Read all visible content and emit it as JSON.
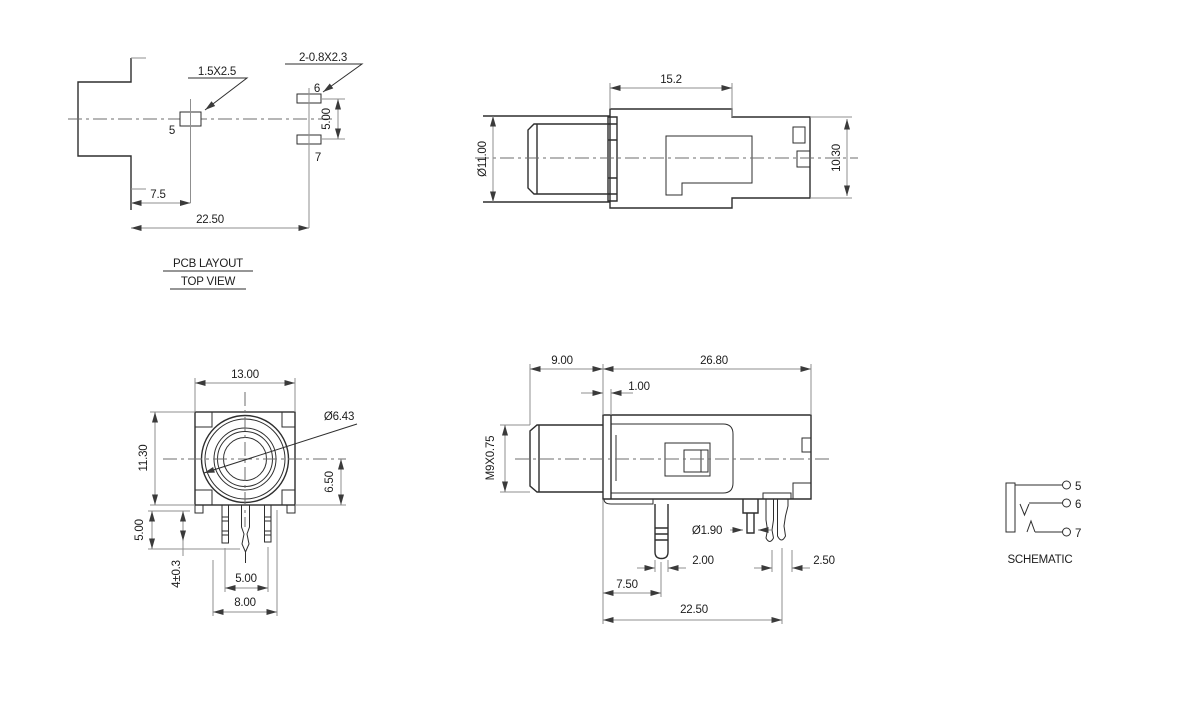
{
  "drawing": {
    "background": "#ffffff",
    "outline_color": "#2e2e2e",
    "dimension_color": "#8f8f8f",
    "text_color": "#1d1d1d"
  },
  "pcb_layout": {
    "title": "PCB LAYOUT",
    "subtitle": "TOP VIEW",
    "pad5_callout": "1.5X2.5",
    "pads67_callout": "2-0.8X2.3",
    "pin5": "5",
    "pin6": "6",
    "pin7": "7",
    "dim_pad_spacing": "5.00",
    "dim_pad5_offset": "7.5",
    "dim_pads67_offset": "22.50"
  },
  "side_view": {
    "dim_body_length": "15.2",
    "dim_barrel_diameter": "Ø11.00",
    "dim_body_height": "10.30"
  },
  "front_view": {
    "dim_width": "13.00",
    "dim_height": "11.30",
    "dim_hole_diameter": "Ø6.43",
    "dim_center_to_bottom": "6.50",
    "dim_pin_projection": "5.00",
    "dim_pin_length": "4±0.3",
    "dim_pin_pitch": "5.00",
    "dim_pin_span": "8.00"
  },
  "bottom_view": {
    "dim_barrel_length": "9.00",
    "dim_body_length": "26.80",
    "dim_panel_thickness": "1.00",
    "dim_thread": "M9X0.75",
    "dim_pin_diameter": "Ø1.90",
    "dim_pin1_width": "2.00",
    "dim_pin3_width": "2.50",
    "dim_pin1_offset": "7.50",
    "dim_pin3_offset": "22.50"
  },
  "schematic": {
    "title": "SCHEMATIC",
    "pin5": "5",
    "pin6": "6",
    "pin7": "7"
  }
}
